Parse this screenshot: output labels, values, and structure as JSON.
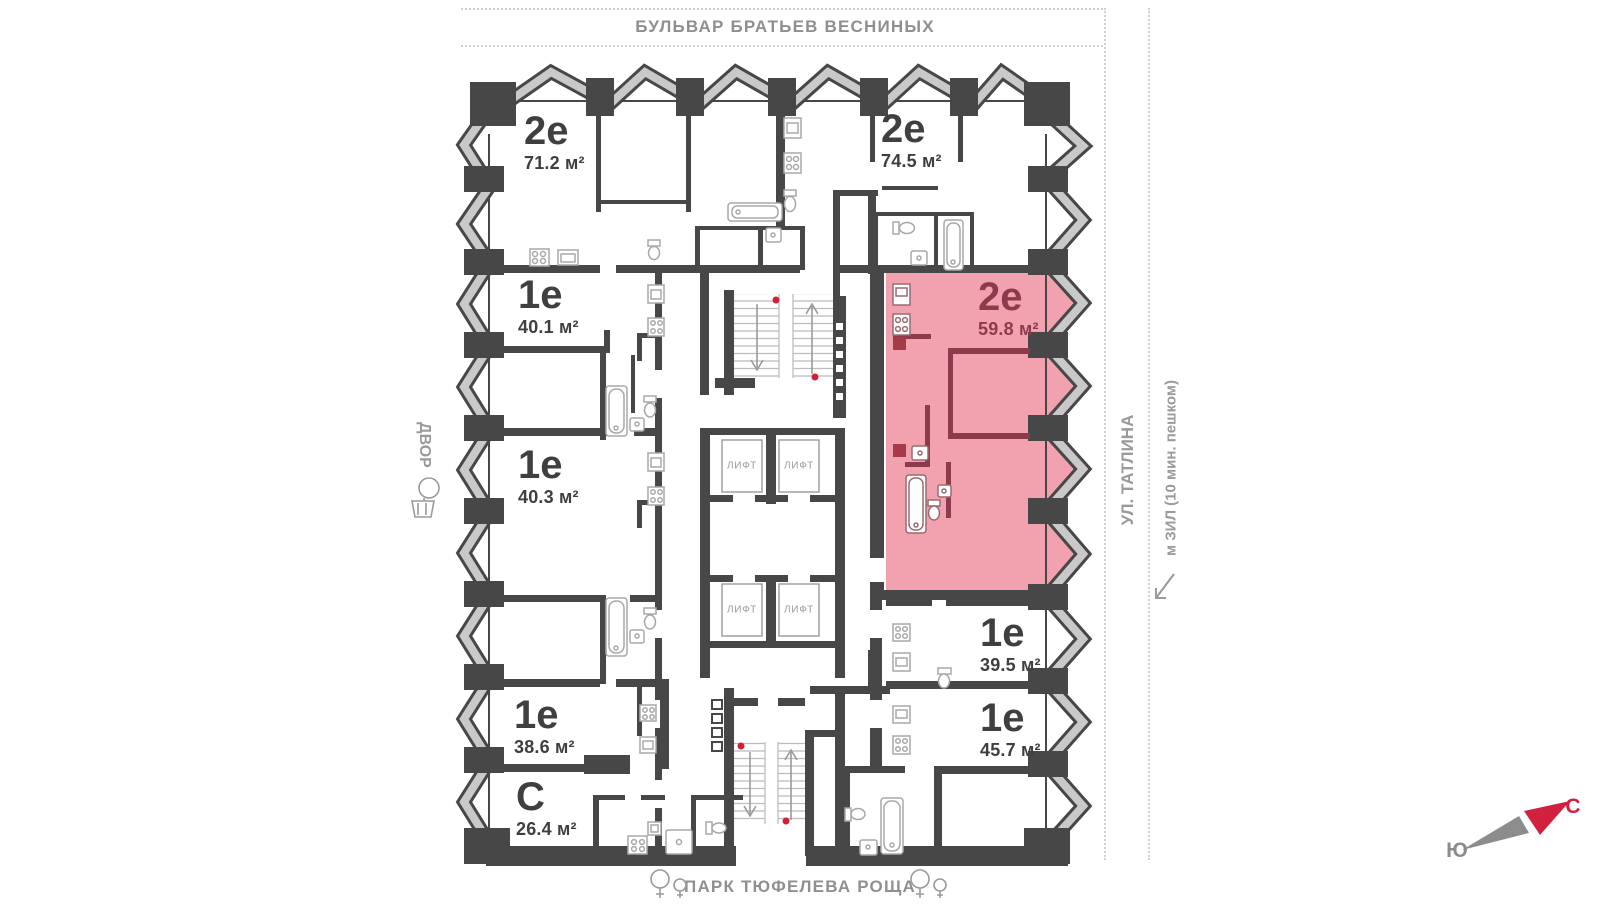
{
  "streets": {
    "top": "БУЛЬВАР БРАТЬЕВ ВЕСНИНЫХ",
    "left": "ДВОР",
    "right_primary": "УЛ. ТАТЛИНА",
    "right_secondary": "м ЗИЛ (10 мин. пешком)",
    "bottom": "ПАРК ТЮФЕЛЕВА РОЩА"
  },
  "compass": {
    "north": "С",
    "south": "Ю",
    "north_color": "#d2203f",
    "south_color": "#8c8c8c"
  },
  "elevators": {
    "label": "ЛИФТ",
    "count": 4
  },
  "apartments": [
    {
      "type": "2е",
      "area": "71.2 м²",
      "highlighted": false
    },
    {
      "type": "2е",
      "area": "74.5 м²",
      "highlighted": false
    },
    {
      "type": "1е",
      "area": "40.1 м²",
      "highlighted": false
    },
    {
      "type": "1е",
      "area": "40.3 м²",
      "highlighted": false
    },
    {
      "type": "1е",
      "area": "38.6 м²",
      "highlighted": false
    },
    {
      "type": "С",
      "area": "26.4 м²",
      "highlighted": false
    },
    {
      "type": "2е",
      "area": "59.8 м²",
      "highlighted": true
    },
    {
      "type": "1е",
      "area": "39.5 м²",
      "highlighted": false
    },
    {
      "type": "1е",
      "area": "45.7 м²",
      "highlighted": false
    }
  ],
  "colors": {
    "walls": "#474747",
    "highlight_fill": "#f2a2ae",
    "highlight_walls": "#8e3a4d",
    "stair_dot": "#cf2038",
    "facade_band": "#c9c9c9"
  }
}
